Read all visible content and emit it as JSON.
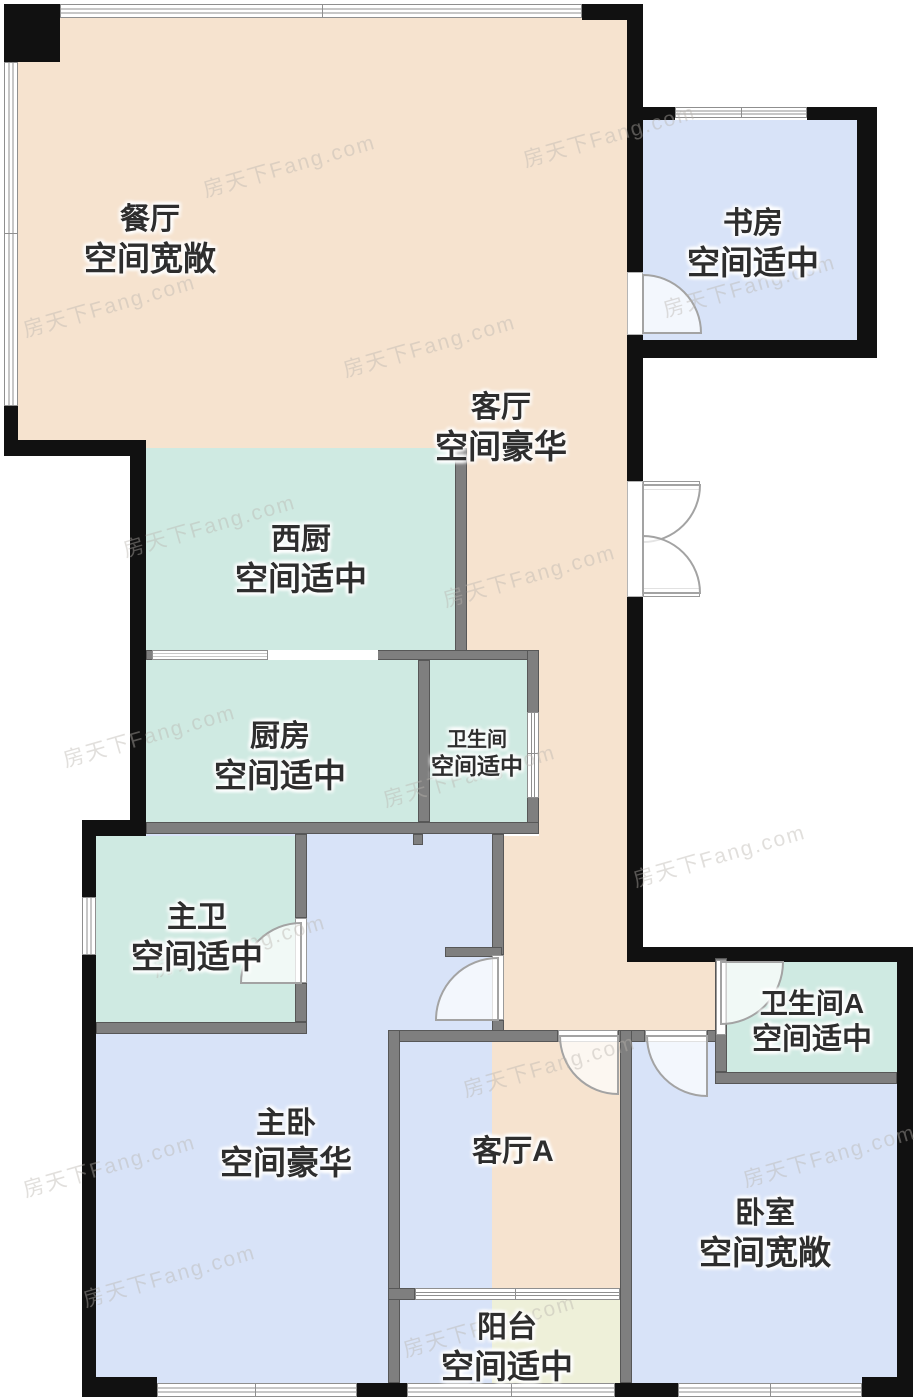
{
  "watermark": {
    "text": "房天下Fang.com"
  },
  "rooms": {
    "dining": {
      "name": "餐厅",
      "desc": "空间宽敞"
    },
    "study": {
      "name": "书房",
      "desc": "空间适中"
    },
    "living": {
      "name": "客厅",
      "desc": "空间豪华"
    },
    "west_kitchen": {
      "name": "西厨",
      "desc": "空间适中"
    },
    "kitchen": {
      "name": "厨房",
      "desc": "空间适中"
    },
    "bathroom": {
      "name": "卫生间",
      "desc": "空间适中"
    },
    "master_bath": {
      "name": "主卫",
      "desc": "空间适中"
    },
    "master_bed": {
      "name": "主卧",
      "desc": "空间豪华"
    },
    "living_a": {
      "name": "客厅A"
    },
    "bathroom_a": {
      "name": "卫生间A",
      "desc": "空间适中"
    },
    "bedroom": {
      "name": "卧室",
      "desc": "空间宽敞"
    },
    "balcony": {
      "name": "阳台",
      "desc": "空间适中"
    }
  },
  "colors": {
    "peach": "#f6e3cf",
    "mint": "#cfeae2",
    "blue": "#d8e3f8",
    "balcony": "#eef0d9",
    "wall_black": "#111111",
    "wall_gray": "#7f7f7f",
    "window_line": "#8f8f8f",
    "watermark": "#b9b4ae",
    "label": "#2e2e2e"
  }
}
